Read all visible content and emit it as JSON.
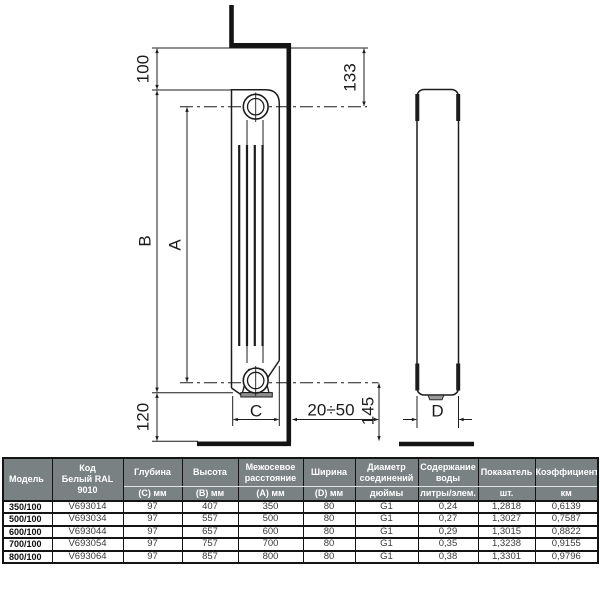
{
  "diagram": {
    "labels": {
      "dim_top_offset": "100",
      "dim_axis_offset": "133",
      "dim_height": "B",
      "dim_axial": "A",
      "dim_bottom_offset": "120",
      "dim_depth": "C",
      "dim_wall_gap": "20÷50",
      "dim_floor_axis": "145",
      "dim_width": "D"
    }
  },
  "table": {
    "headers": {
      "model": "Модель",
      "code": "Код\nБелый RAL\n9010",
      "depth": "Глубина",
      "depth_unit": "(C) мм",
      "height": "Высота",
      "height_unit": "(B) мм",
      "axial": "Межосевое\nрасстояние",
      "axial_unit": "(A) мм",
      "width": "Ширина",
      "width_unit": "(D) мм",
      "diameter": "Диаметр\nсоединений",
      "diameter_unit": "дюймы",
      "water": "Содержание\nводы",
      "water_unit": "литры/элем.",
      "indicator": "Показатель",
      "indicator_unit": "шт.",
      "coefficient": "Коэффициент",
      "coefficient_unit": "км"
    },
    "rows": [
      {
        "model": "350/100",
        "code": "V693014",
        "depth": "97",
        "height": "407",
        "axial": "350",
        "width": "80",
        "diameter": "G1",
        "water": "0,24",
        "indicator": "1,2818",
        "coefficient": "0,6139"
      },
      {
        "model": "500/100",
        "code": "V693034",
        "depth": "97",
        "height": "557",
        "axial": "500",
        "width": "80",
        "diameter": "G1",
        "water": "0,27",
        "indicator": "1,3027",
        "coefficient": "0,7587"
      },
      {
        "model": "600/100",
        "code": "V693044",
        "depth": "97",
        "height": "657",
        "axial": "600",
        "width": "80",
        "diameter": "G1",
        "water": "0,29",
        "indicator": "1,3015",
        "coefficient": "0,8822"
      },
      {
        "model": "700/100",
        "code": "V693054",
        "depth": "97",
        "height": "757",
        "axial": "700",
        "width": "80",
        "diameter": "G1",
        "water": "0,35",
        "indicator": "1,3238",
        "coefficient": "0,9155"
      },
      {
        "model": "800/100",
        "code": "V693064",
        "depth": "97",
        "height": "857",
        "axial": "800",
        "width": "80",
        "diameter": "G1",
        "water": "0,38",
        "indicator": "1,3301",
        "coefficient": "0,9796"
      }
    ]
  },
  "colors": {
    "line": "#1c1c1c",
    "header_bg": "#7a8183",
    "header_text": "#ffffff",
    "body_text": "#3a3a3a",
    "plate_fill": "#8d8d8d"
  }
}
